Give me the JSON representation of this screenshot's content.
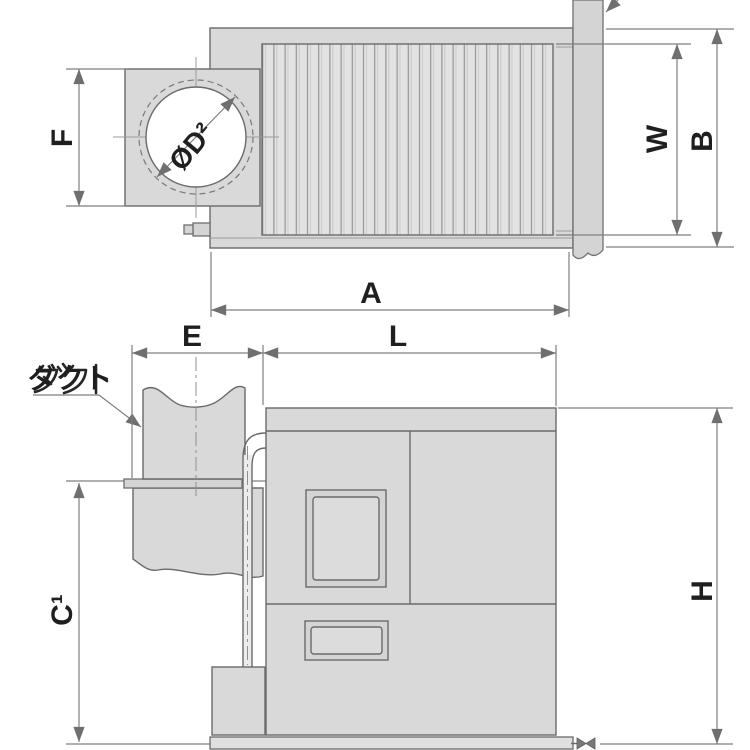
{
  "top_view": {
    "labels": {
      "F": "F",
      "A": "A",
      "W": "W",
      "B": "B",
      "duct_diameter": "ØD²"
    }
  },
  "side_view": {
    "labels": {
      "E": "E",
      "L": "L",
      "C1": "C¹",
      "H": "H",
      "duct": "ダクト"
    }
  },
  "colors": {
    "background": "#ffffff",
    "body_fill": "#d9d9d9",
    "fin_fill": "#e2e2e2",
    "duct_fill": "#d4d4d4",
    "opening_fill": "#ffffff",
    "outline": "#6a6a6a",
    "dimension_line": "#7f7f7f",
    "label_text": "#1f1f1f"
  }
}
